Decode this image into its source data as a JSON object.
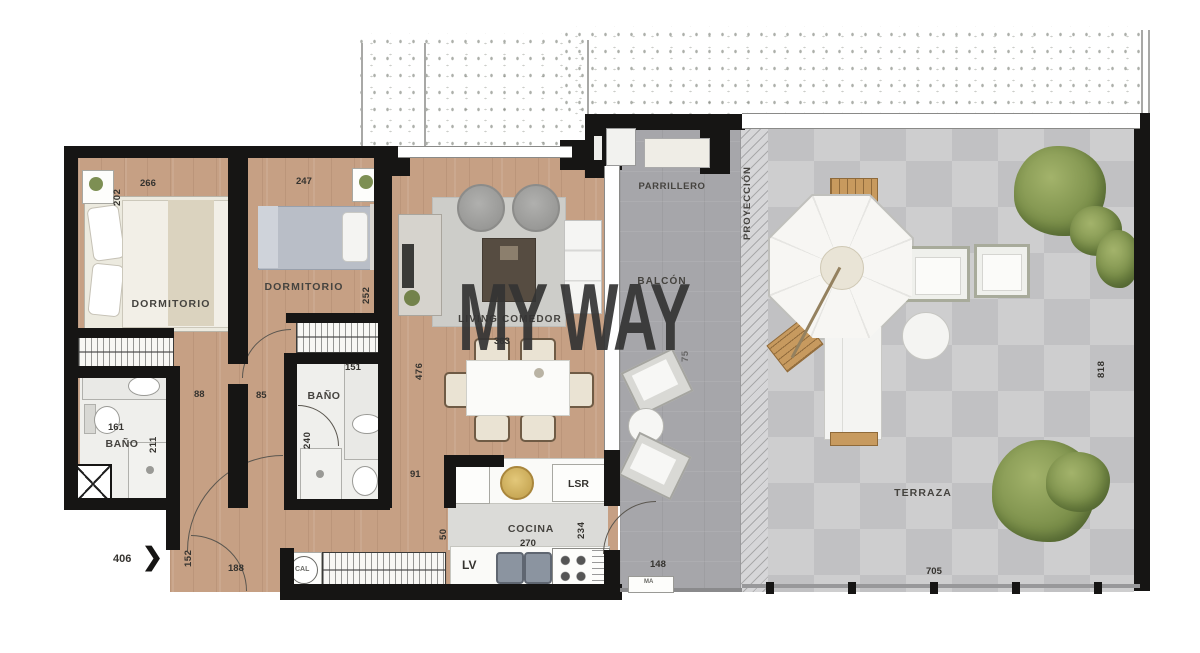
{
  "watermark": "MY WAY",
  "rooms": {
    "bedroom1": {
      "name": "DORMITORIO",
      "width": "266",
      "depth": "202"
    },
    "bedroom2": {
      "name": "DORMITORIO",
      "width": "247",
      "depth": "252"
    },
    "bathroom1": {
      "name": "BAÑO",
      "code": "161",
      "depth": "211"
    },
    "bathroom2": {
      "name": "BAÑO",
      "code": "151",
      "depth": "240"
    },
    "living": {
      "name": "LIVING COMEDOR",
      "width": "363",
      "depth": "476"
    },
    "kitchen": {
      "name": "COCINA",
      "width": "270",
      "depth": "234",
      "pass": "50",
      "washer": "LSR",
      "dishwasher": "LV",
      "heater": "CAL"
    },
    "balcony": {
      "name": "BALCÓN",
      "grill": "PARRILLERO",
      "width": "148",
      "depth": "75",
      "marker": "MA"
    },
    "projection": {
      "name": "PROYECCIÓN"
    },
    "terrace": {
      "name": "TERRAZA",
      "width": "705",
      "depth": "818"
    }
  },
  "hall": {
    "d88": "88",
    "d85": "85",
    "d91": "91",
    "d188": "188",
    "d152": "152"
  },
  "entry": {
    "unit": "406",
    "arrow": "❯"
  },
  "colors": {
    "wall": "#161514",
    "wood": "#c6a084",
    "balcony": "#a6a6aa",
    "terrace": "#c8c8ca"
  }
}
